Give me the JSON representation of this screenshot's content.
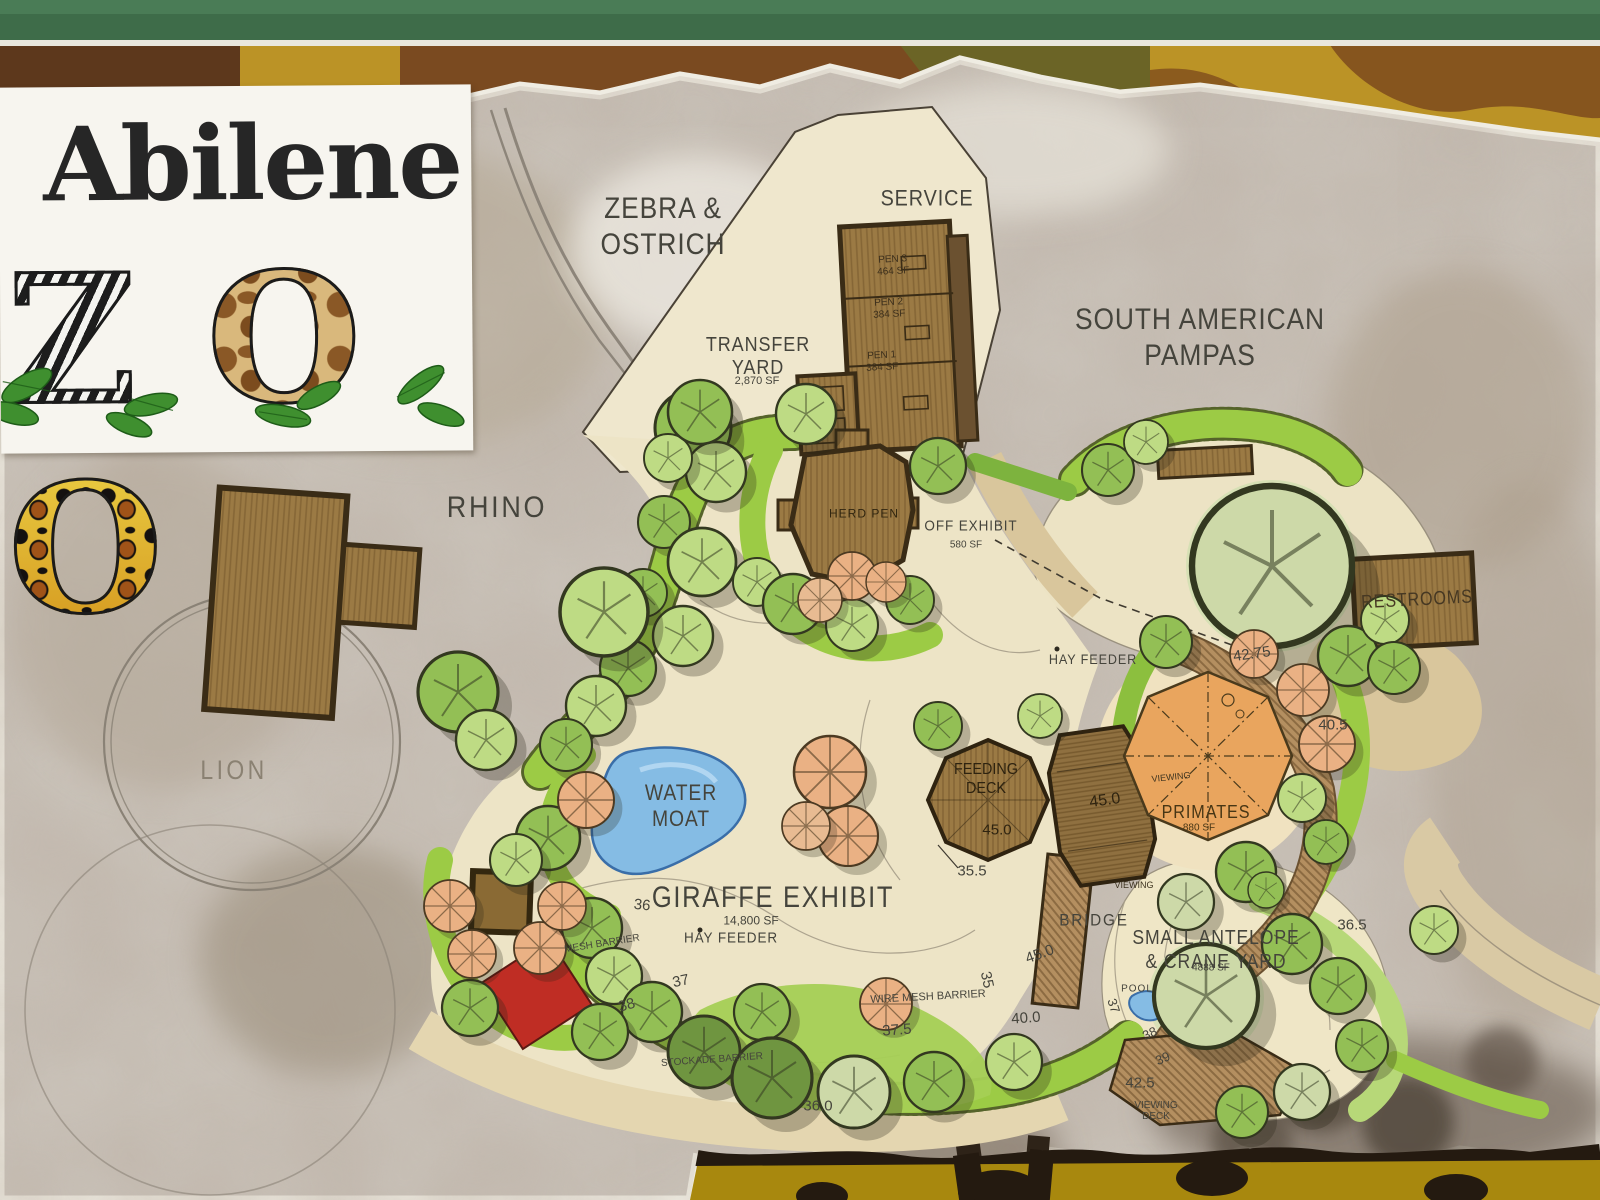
{
  "sign": {
    "logo": {
      "title": "Abilene",
      "zoo_letters": [
        "Z",
        "O",
        "O"
      ]
    },
    "labels": [
      {
        "name": "label-zebra-ostrich",
        "t": "ZEBRA &\nOSTRICH",
        "x": 663,
        "y": 227,
        "fs": 30,
        "lh": 36,
        "ls": 1,
        "sx": 0.88
      },
      {
        "name": "label-service",
        "t": "SERVICE",
        "x": 927,
        "y": 199,
        "fs": 22,
        "ls": 1,
        "sx": 0.9
      },
      {
        "name": "label-south-american-pampas",
        "t": "SOUTH AMERICAN\nPAMPAS",
        "x": 1200,
        "y": 338,
        "fs": 30,
        "lh": 36,
        "ls": 1,
        "sx": 0.88
      },
      {
        "name": "label-transfer-yard",
        "t": "TRANSFER\nYARD",
        "x": 758,
        "y": 357,
        "fs": 20,
        "lh": 23,
        "ls": 1,
        "sx": 0.9
      },
      {
        "name": "label-transfer-yard-area",
        "t": "2,870 SF",
        "x": 757,
        "y": 381,
        "fs": 11
      },
      {
        "name": "label-rhino",
        "t": "RHINO",
        "x": 497,
        "y": 508,
        "fs": 30,
        "ls": 3,
        "sx": 0.9
      },
      {
        "name": "label-lion",
        "t": "LION",
        "x": 234,
        "y": 770,
        "fs": 27,
        "ls": 4,
        "c": "#8a8172",
        "sx": 0.85
      },
      {
        "name": "label-restrooms",
        "t": "RESTROOMS",
        "x": 1417,
        "y": 600,
        "fs": 19,
        "rot": -3,
        "c": "#463823",
        "ls": 1,
        "sx": 0.85
      },
      {
        "name": "label-pen-3",
        "t": "PEN 3\n464 SF",
        "x": 893,
        "y": 266,
        "fs": 10,
        "lh": 12,
        "c": "#3c2f1c",
        "rot": -3
      },
      {
        "name": "label-pen-2",
        "t": "PEN 2\n384 SF",
        "x": 889,
        "y": 309,
        "fs": 10,
        "lh": 12,
        "c": "#3c2f1c",
        "rot": -3
      },
      {
        "name": "label-pen-1",
        "t": "PEN 1\n384 SF",
        "x": 882,
        "y": 362,
        "fs": 10,
        "lh": 12,
        "c": "#3c2f1c",
        "rot": -3
      },
      {
        "name": "label-herd-pen",
        "t": "HERD PEN",
        "x": 864,
        "y": 514,
        "fs": 12,
        "ls": 1,
        "c": "#30250f"
      },
      {
        "name": "label-off-exhibit",
        "t": "OFF EXHIBIT",
        "x": 971,
        "y": 527,
        "fs": 15,
        "ls": 1,
        "sx": 0.9
      },
      {
        "name": "label-off-exhibit-area",
        "t": "580 SF",
        "x": 966,
        "y": 545,
        "fs": 10
      },
      {
        "name": "label-hay-feeder-east",
        "t": "HAY FEEDER",
        "x": 1093,
        "y": 660,
        "fs": 14,
        "ls": 1,
        "sx": 0.9
      },
      {
        "name": "label-water-moat",
        "t": "WATER\nMOAT",
        "x": 681,
        "y": 806,
        "fs": 22,
        "lh": 26,
        "ls": 1,
        "sx": 0.88
      },
      {
        "name": "label-feeding-deck",
        "t": "FEEDING\nDECK",
        "x": 986,
        "y": 779,
        "fs": 16,
        "lh": 19,
        "c": "#2e2310",
        "sx": 0.9
      },
      {
        "name": "label-elev-feeding-deck",
        "t": "45.0",
        "x": 997,
        "y": 831,
        "fs": 15,
        "c": "#2e2310"
      },
      {
        "name": "label-elev-deck2",
        "t": "45.0",
        "x": 1105,
        "y": 801,
        "fs": 16,
        "c": "#2e2310",
        "rot": -8
      },
      {
        "name": "label-primates",
        "t": "PRIMATES",
        "x": 1206,
        "y": 812,
        "fs": 18,
        "ls": 1,
        "c": "#473615",
        "sx": 0.9
      },
      {
        "name": "label-primates-area",
        "t": "880 SF",
        "x": 1199,
        "y": 828,
        "fs": 10,
        "c": "#473615"
      },
      {
        "name": "label-viewing-north",
        "t": "VIEWING",
        "x": 1171,
        "y": 777,
        "fs": 9,
        "rot": -6,
        "c": "#3e3420"
      },
      {
        "name": "label-viewing-south",
        "t": "VIEWING",
        "x": 1134,
        "y": 885,
        "fs": 9,
        "c": "#3e3420"
      },
      {
        "name": "label-elev-35-5",
        "t": "35.5",
        "x": 972,
        "y": 872,
        "fs": 15
      },
      {
        "name": "label-giraffe-exhibit",
        "t": "GIRAFFE EXHIBIT",
        "x": 773,
        "y": 898,
        "fs": 30,
        "ls": 2,
        "sx": 0.85
      },
      {
        "name": "label-giraffe-exhibit-area",
        "t": "14,800 SF",
        "x": 751,
        "y": 921,
        "fs": 12
      },
      {
        "name": "label-hay-feeder-west",
        "t": "HAY FEEDER",
        "x": 731,
        "y": 939,
        "fs": 15,
        "ls": 1,
        "sx": 0.9
      },
      {
        "name": "label-elev-36",
        "t": "36",
        "x": 642,
        "y": 906,
        "fs": 15,
        "rot": 6
      },
      {
        "name": "label-mesh-barrier",
        "t": "MESH BARRIER",
        "x": 602,
        "y": 944,
        "fs": 10,
        "rot": -9
      },
      {
        "name": "label-elev-37",
        "t": "37",
        "x": 681,
        "y": 982,
        "fs": 15,
        "rot": -12
      },
      {
        "name": "label-elev-38",
        "t": "38",
        "x": 627,
        "y": 1006,
        "fs": 15,
        "rot": -16
      },
      {
        "name": "label-wire-mesh-barrier",
        "t": "WIRE MESH BARRIER",
        "x": 928,
        "y": 997,
        "fs": 11,
        "rot": -3
      },
      {
        "name": "label-elev-35",
        "t": "35",
        "x": 986,
        "y": 980,
        "fs": 15,
        "rot": 78
      },
      {
        "name": "label-elev-45-path",
        "t": "45.0",
        "x": 1040,
        "y": 955,
        "fs": 15,
        "rot": -20
      },
      {
        "name": "label-elev-40",
        "t": "40.0",
        "x": 1026,
        "y": 1019,
        "fs": 15,
        "rot": -4
      },
      {
        "name": "label-elev-37-5",
        "t": "37.5",
        "x": 897,
        "y": 1031,
        "fs": 15,
        "rot": -4
      },
      {
        "name": "label-stockade-barrier",
        "t": "STOCKADE BARRIER",
        "x": 712,
        "y": 1060,
        "fs": 10,
        "rot": -4
      },
      {
        "name": "label-bridge",
        "t": "BRIDGE",
        "x": 1094,
        "y": 920,
        "fs": 17,
        "ls": 2,
        "sx": 0.9
      },
      {
        "name": "label-small-antelope",
        "t": "SMALL ANTELOPE\n& CRANE YARD",
        "x": 1216,
        "y": 950,
        "fs": 20,
        "lh": 24,
        "ls": 1,
        "sx": 0.88
      },
      {
        "name": "label-antelope-area",
        "t": "4888 SF",
        "x": 1211,
        "y": 968,
        "fs": 10
      },
      {
        "name": "label-pool",
        "t": "POOL",
        "x": 1137,
        "y": 989,
        "fs": 10,
        "ls": 1
      },
      {
        "name": "label-elev-37b",
        "t": "37",
        "x": 1113,
        "y": 1006,
        "fs": 13,
        "rot": 72
      },
      {
        "name": "label-elev-38b",
        "t": "38",
        "x": 1150,
        "y": 1034,
        "fs": 13,
        "rot": -24
      },
      {
        "name": "label-elev-39",
        "t": "39",
        "x": 1163,
        "y": 1059,
        "fs": 13,
        "rot": -24
      },
      {
        "name": "label-elev-42-5",
        "t": "42.5",
        "x": 1140,
        "y": 1084,
        "fs": 15
      },
      {
        "name": "label-viewing-deck",
        "t": "VIEWING\nDECK",
        "x": 1156,
        "y": 1111,
        "fs": 10,
        "lh": 11
      },
      {
        "name": "label-elev-36-0",
        "t": "36.0",
        "x": 818,
        "y": 1107,
        "fs": 15
      },
      {
        "name": "label-elev-36-5",
        "t": "36.5",
        "x": 1352,
        "y": 926,
        "fs": 15
      },
      {
        "name": "label-elev-42-75",
        "t": "42.75",
        "x": 1252,
        "y": 655,
        "fs": 15,
        "rot": -8
      },
      {
        "name": "label-elev-40-5",
        "t": "40.5",
        "x": 1333,
        "y": 726,
        "fs": 15
      }
    ],
    "hay_feeder_markers": [
      {
        "x": 1057,
        "y": 649
      },
      {
        "x": 700,
        "y": 930
      }
    ]
  },
  "palette": {
    "frame_green": "#3e6c49",
    "camo_gold": "#c29a1f",
    "camo_brown": "#7a4a20",
    "camo_maroon": "#5d381c",
    "camo_olive": "#6b6426",
    "bottom_gold": "#a8880e",
    "photo_gray": "#cac3ba",
    "photo_brown": "#8d7a68",
    "plan_cream": "#ede4c6",
    "plan_path": "#d9c69c",
    "green_bright": "#9ccb45",
    "green_light": "#bedb84",
    "green_mid": "#93bf55",
    "green_dark": "#6f9540",
    "green_sage": "#cdd9a8",
    "water": "#85bce4",
    "wood": "#9b7a44",
    "wood_dark": "#3a2c16",
    "deck_orange": "#e9a55e",
    "peach": "#eab184",
    "red_structure": "#bf2d24",
    "label": "#45443c",
    "logo_ink": "#262626"
  }
}
